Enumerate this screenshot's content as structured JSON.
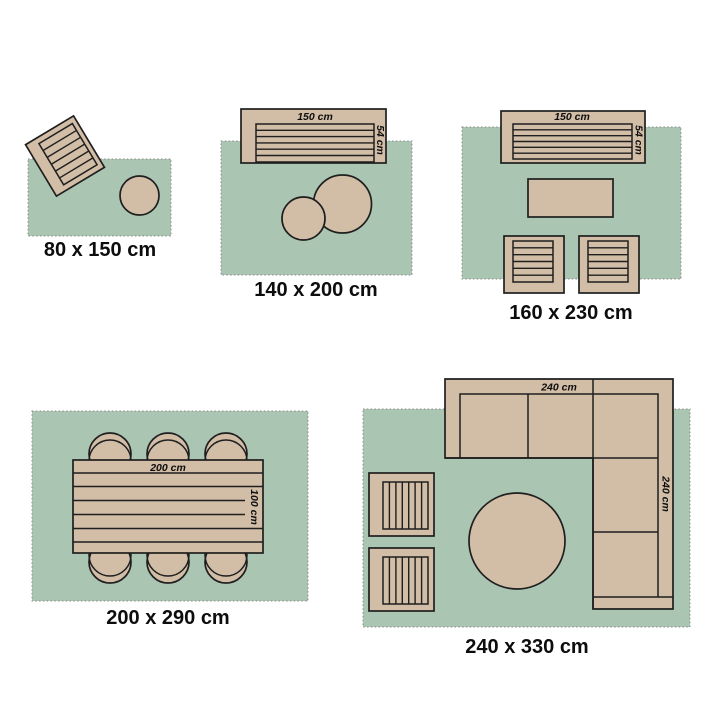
{
  "colors": {
    "background": "#ffffff",
    "rug": "#abc5b3",
    "furniture": "#d2bda6",
    "outline": "#1f1f1f",
    "rug_border": "#8a8a8a",
    "text": "#0d0d0d"
  },
  "diagrams": [
    {
      "size_label": "80 x 150 cm"
    },
    {
      "size_label": "140 x 200 cm",
      "dims": {
        "width": "150 cm",
        "depth": "54 cm"
      }
    },
    {
      "size_label": "160 x 230 cm",
      "dims": {
        "width": "150 cm",
        "depth": "54 cm"
      }
    },
    {
      "size_label": "200 x 290 cm",
      "dims": {
        "width": "200 cm",
        "depth": "100 cm"
      }
    },
    {
      "size_label": "240 x 330 cm",
      "dims": {
        "width": "240 cm",
        "depth": "240 cm"
      }
    }
  ]
}
